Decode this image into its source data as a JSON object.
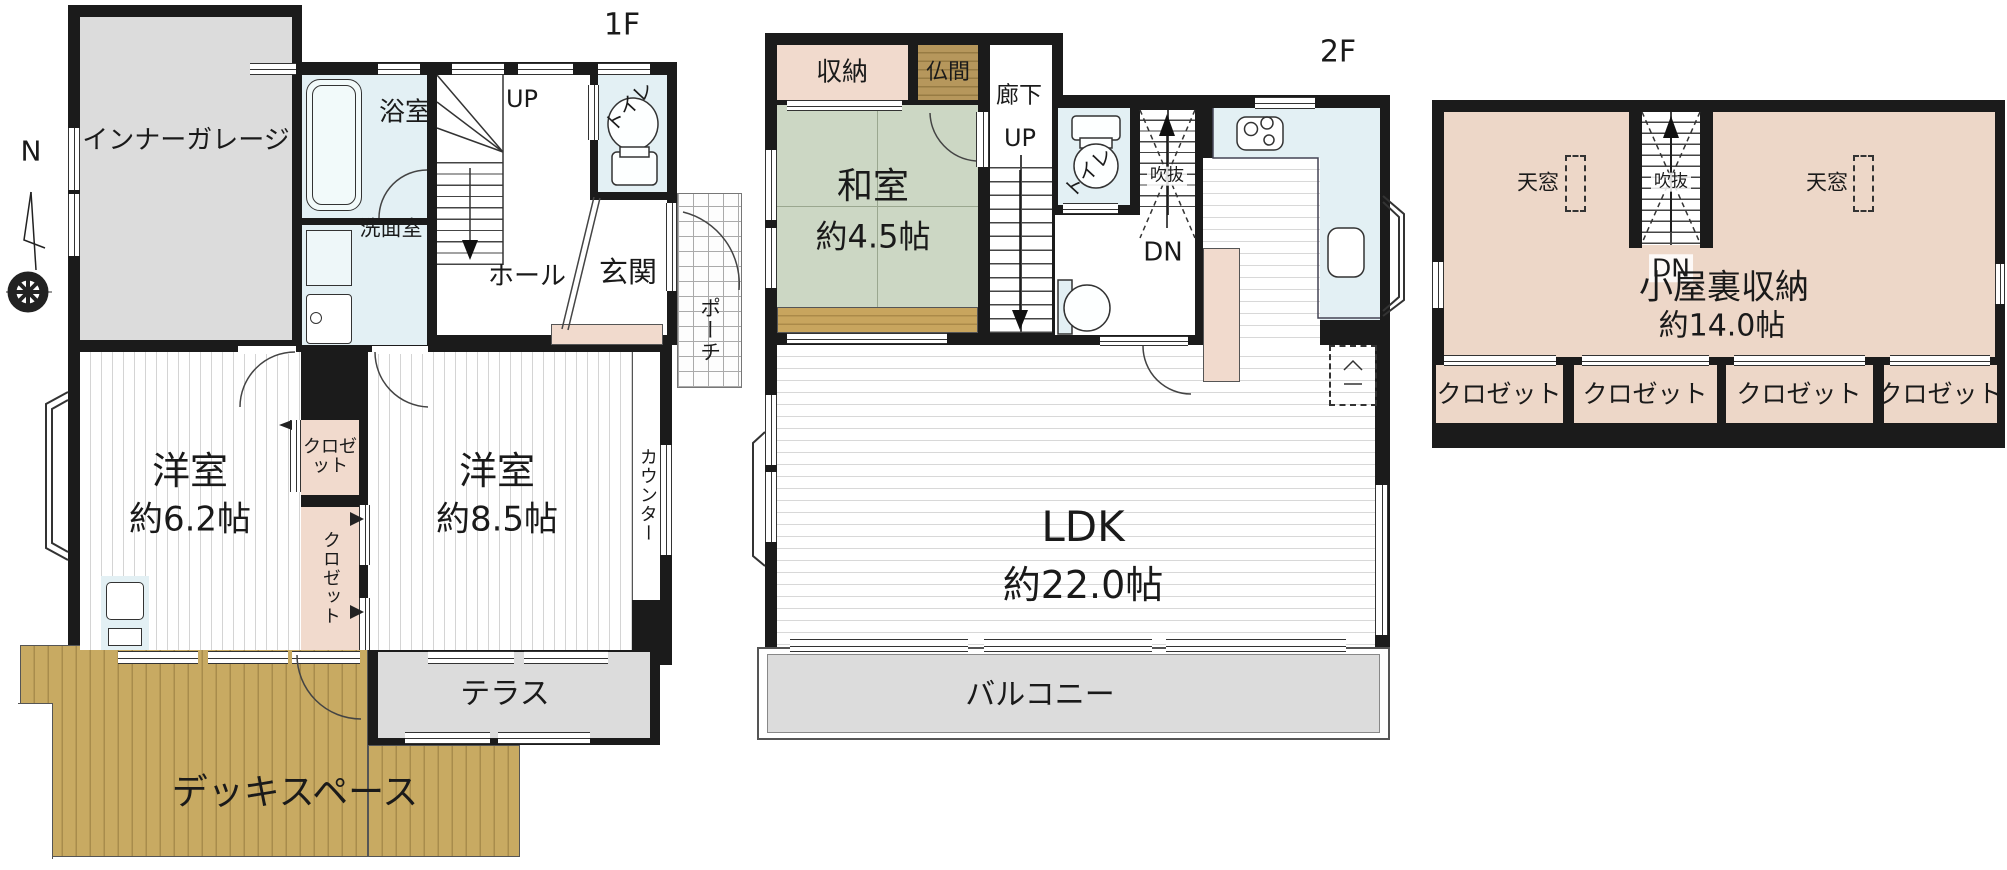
{
  "compass": {
    "north": "N"
  },
  "floor1": {
    "tag": "1F",
    "garage": "インナーガレージ",
    "bath": "浴室",
    "washroom": "洗面室",
    "up": "UP",
    "hall": "ホール",
    "toilet": "トイレ",
    "entrance": "玄関",
    "porch": "ポーチ",
    "bedroom_a": {
      "name": "洋室",
      "size": "約6.2帖"
    },
    "bedroom_b": {
      "name": "洋室",
      "size": "約8.5帖"
    },
    "closet_upper": "クロゼット",
    "closet_lower": "クロゼット",
    "counter": "カウンター",
    "terrace": "テラス",
    "deck": "デッキスペース"
  },
  "floor2": {
    "tag": "2F",
    "storage": "収納",
    "altar_room": "仏間",
    "corridor": "廊下",
    "up": "UP",
    "japanese_room": {
      "name": "和室",
      "size": "約4.5帖"
    },
    "toilet": "トイレ",
    "void": "吹抜",
    "down": "DN",
    "ldk": {
      "name": "LDK",
      "size": "約22.0帖"
    },
    "balcony": "バルコニー"
  },
  "attic": {
    "skylight_left": "天窓",
    "skylight_right": "天窓",
    "void": "吹抜",
    "down": "DN",
    "room": {
      "name": "小屋裏収納",
      "size": "約14.0帖"
    },
    "closets": [
      "クロゼット",
      "クロゼット",
      "クロゼット",
      "クロゼット"
    ]
  },
  "colors": {
    "wall": "#1b1b1b",
    "wet_area": "#e3f0f4",
    "closet_pink": "#f1dacd",
    "attic_pink": "#edd7c8",
    "tatami_green": "#ccd7c4",
    "wood_brown": "#b6975c",
    "deck_tan": "#c8aa62",
    "concrete_gray": "#dcdcdc"
  }
}
